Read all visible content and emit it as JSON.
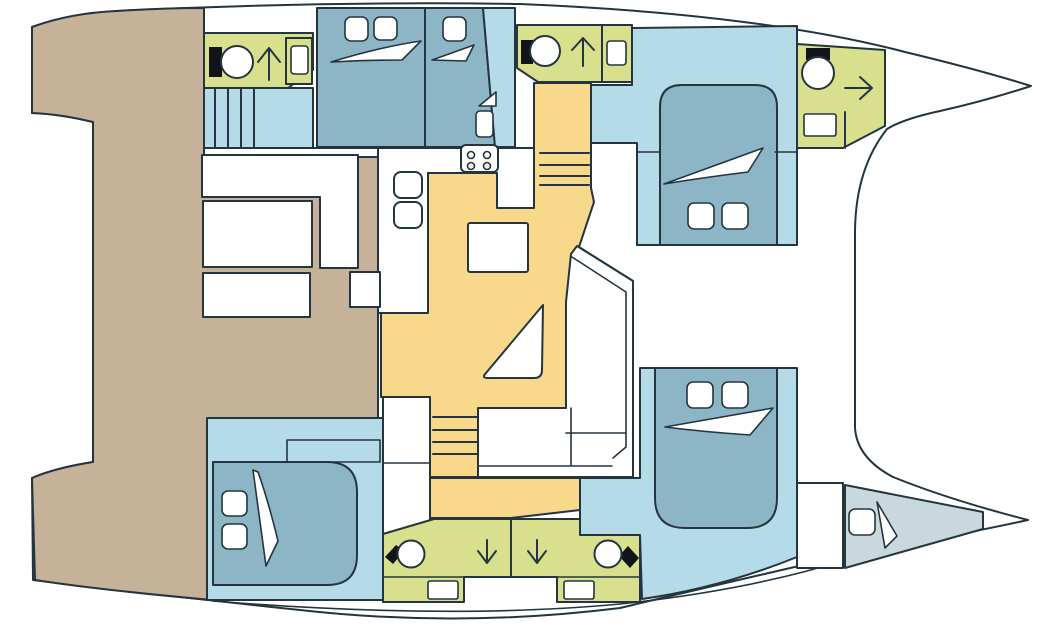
{
  "plan": {
    "vessel": "catamaran",
    "view": "top-down interior deck plan",
    "bow_direction": "right",
    "hull_count": 2
  },
  "colors": {
    "background": "#ffffff",
    "outline": "#243540",
    "deck": "#c6b299",
    "room": "#b5dae8",
    "bed": "#8cb6c6",
    "bathroom": "#d8e08d",
    "salon_floor": "#f8d88b",
    "forepeak": "#c9d8dc",
    "furniture": "#ffffff",
    "fixture_dark": "#121417"
  },
  "inventory": {
    "double_berths": 4,
    "forepeak_berths": 1,
    "bathrooms": 5,
    "toilets": 5,
    "shower_symbols": 5,
    "staircases": 3,
    "cockpit_tables": 2,
    "salon_tables": 2,
    "galley_burners": 4,
    "galley_sinks": 2,
    "bathroom_sinks": 4,
    "pillows": 9,
    "forepeak_windows": 1
  }
}
